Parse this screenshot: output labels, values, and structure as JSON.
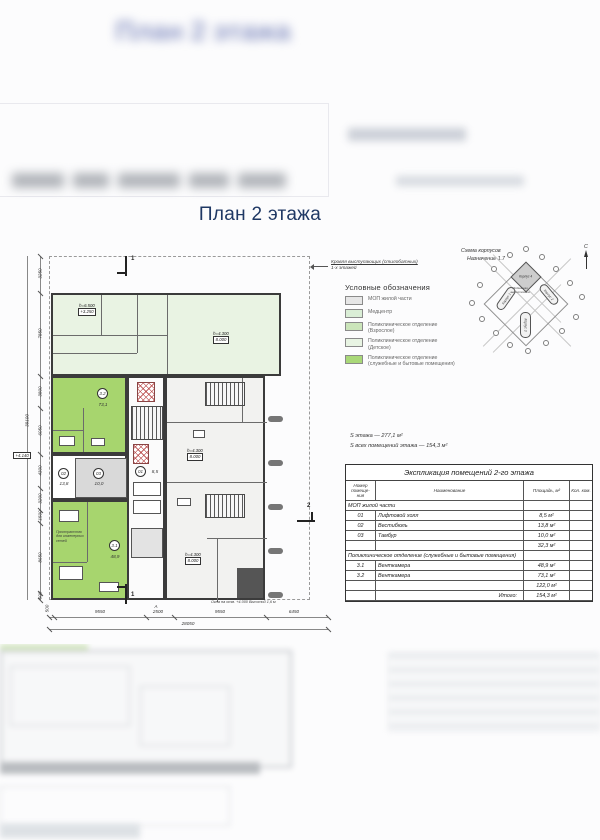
{
  "page": {
    "title": "План 2 этажа",
    "ghost_title": "План 2 этажа"
  },
  "plan": {
    "roof_note_line1": "Кровля выступающих (стилобатных)",
    "roof_note_line2": "1-х этажей",
    "window_note": "Окна на отм. +4.000 Высотой 1,6 м",
    "space_note": "Пространство для инженерных сетей",
    "level_top": {
      "h": "h=6.500",
      "mark": "+3.250"
    },
    "level_main": {
      "h": "h=4.300",
      "mark": "8.000"
    },
    "elevation_tag": "+4.140",
    "room_32": {
      "num": "3.2",
      "area": "73,1"
    },
    "room_31": {
      "num": "3.1",
      "area": "48,9"
    },
    "room_01": {
      "num": "01",
      "area": "8,5"
    },
    "room_02": {
      "num": "02",
      "area": "13,8"
    },
    "room_03": {
      "num": "03",
      "area": "10,0"
    },
    "dims_left": [
      "3250",
      "7850",
      "3800",
      "6050",
      "4300",
      "3200",
      "1500",
      "8650",
      "500"
    ],
    "dims_left_total": "39100",
    "dims_bottom": [
      "500",
      "9550",
      "2500",
      "9550",
      "6450"
    ],
    "dims_bottom_total": "28050",
    "section_top": "1",
    "section_bottom": "1",
    "section_right": "2",
    "axis_bottom": "А"
  },
  "scheme": {
    "title_line1": "Схема корпусов",
    "title_line2": "Назначение 1.7",
    "compass": "С",
    "center_label": "Подземная автостоянка",
    "block1": "Корпус 1",
    "block2": "Корпус 2",
    "block3": "Корпус 3",
    "block4": "Корпус 4"
  },
  "legend": {
    "title": "Условные обозначения",
    "items": [
      {
        "label": "МОП жилой части",
        "color": "#e6e6e6"
      },
      {
        "label": "Медцентр",
        "color": "#daeed6"
      },
      {
        "label": "Поликлиническое отделение (Взрослое)",
        "color": "#cbe5ba"
      },
      {
        "label": "Поликлиническое отделение (Детское)",
        "color": "#e8f4e3"
      },
      {
        "label": "Поликлиническое отделение (служебные и бытовые помещения)",
        "color": "#a9d878"
      }
    ]
  },
  "summary": {
    "line1": "S этажа — 277,1 м²",
    "line2": "S всех помещений этажа — 154,3 м²"
  },
  "table": {
    "title": "Экспликация помещений 2-го этажа",
    "col_num": "Номер помеще- ния",
    "col_name": "Наименование",
    "col_area": "Площадь, м²",
    "col_count": "Кол. ком.",
    "rows": [
      {
        "num": "",
        "name": "МОП жилой части",
        "area": ""
      },
      {
        "num": "01",
        "name": "Лифтовой холл",
        "area": "8,5 м²"
      },
      {
        "num": "02",
        "name": "Вестибюль",
        "area": "13,8 м²"
      },
      {
        "num": "03",
        "name": "Тамбур",
        "area": "10,0 м²"
      },
      {
        "num": "",
        "name": "",
        "area": "32,3 м²"
      },
      {
        "num": "",
        "name": "Поликлиническое отделение (служебные и бытовые помещения)",
        "area": ""
      },
      {
        "num": "3.1",
        "name": "Венткамера",
        "area": "48,9 м²"
      },
      {
        "num": "3.2",
        "name": "Венткамера",
        "area": "73,1 м²"
      },
      {
        "num": "",
        "name": "",
        "area": "122,0 м²"
      },
      {
        "num": "",
        "name": "Итого:",
        "area": "154,3 м²"
      }
    ]
  }
}
